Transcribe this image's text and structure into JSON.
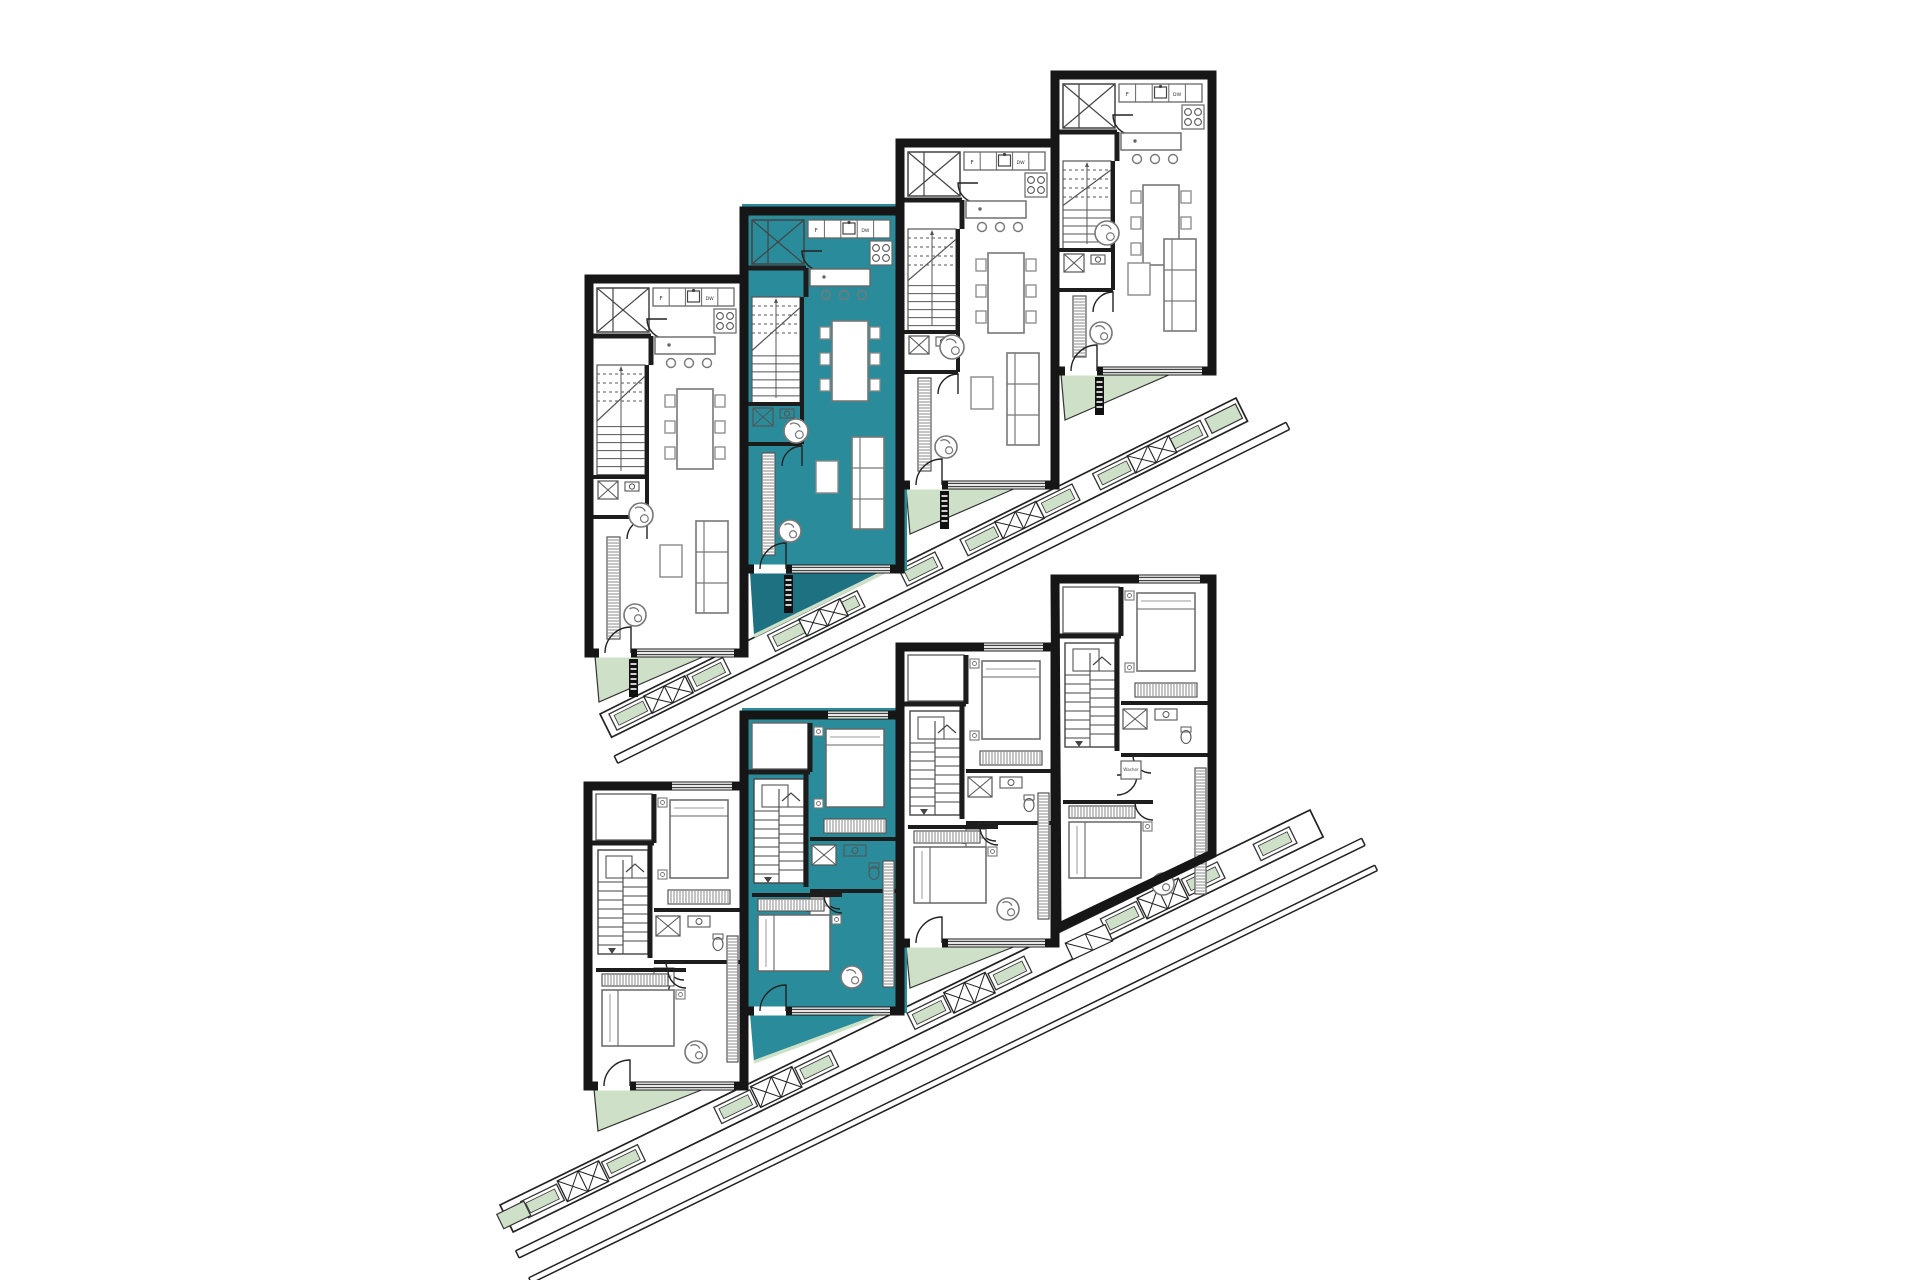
{
  "page": {
    "title": "Stacked townhouse floor plans with highlighted unit 2"
  },
  "canvas": {
    "w": 1920,
    "h": 1280,
    "bg": "#ffffff"
  },
  "colors": {
    "wall": "#161616",
    "partition": "#1c1c1c",
    "furniture": "#7d7d7d",
    "furniture_dark": "#4a4a4a",
    "line_dark": "#222222",
    "highlight": "#2A8C9A",
    "highlight_dark": "#1E7181",
    "planter_green": "#CFE0C8",
    "planter_stroke": "#333333",
    "white": "#ffffff"
  },
  "labels": {
    "fridge": "F",
    "dishwasher": "DW",
    "washer": "Washer"
  },
  "floors": [
    {
      "id": "upper-living-level",
      "unit_type": "living",
      "units": [
        {
          "id": "unit-1-living",
          "x": 589,
          "y": 279,
          "w": 155,
          "h": 374,
          "highlighted": false
        },
        {
          "id": "unit-2-living",
          "x": 744,
          "y": 211,
          "w": 156,
          "h": 358,
          "highlighted": true
        },
        {
          "id": "unit-3-living",
          "x": 900,
          "y": 143,
          "w": 155,
          "h": 342,
          "highlighted": false
        },
        {
          "id": "unit-4-living",
          "x": 1055,
          "y": 75,
          "w": 157,
          "h": 296,
          "highlighted": false
        }
      ],
      "wedge_depth": {
        "normal": 46,
        "highlight": 64
      },
      "promenade": {
        "p1": [
          600,
          714
        ],
        "p2": [
          1236,
          398
        ],
        "band_w": 26,
        "planters_t": [
          28,
          115,
          205,
          265,
          352,
          420,
          505,
          568,
          648
        ],
        "stairs_t": [
          70,
          243,
          462,
          610
        ],
        "rails": [
          [
            44,
            52
          ]
        ],
        "end_planter_t": 690
      },
      "ladders": true
    },
    {
      "id": "lower-bedroom-level",
      "unit_type": "bedroom",
      "units": [
        {
          "id": "unit-1-bedroom",
          "x": 588,
          "y": 786,
          "w": 156,
          "h": 300,
          "highlighted": false
        },
        {
          "id": "unit-2-bedroom",
          "x": 744,
          "y": 715,
          "w": 156,
          "h": 296,
          "highlighted": true
        },
        {
          "id": "unit-3-bedroom",
          "x": 900,
          "y": 647,
          "w": 155,
          "h": 296,
          "highlighted": false
        },
        {
          "id": "unit-4-bedroom",
          "x": 1055,
          "y": 579,
          "w": 157,
          "h": 296,
          "highlighted": false,
          "poly": [
            [
              1055,
              579
            ],
            [
              1212,
              579
            ],
            [
              1212,
              854
            ],
            [
              1057,
              928
            ]
          ]
        }
      ],
      "wedge_depth": {
        "normal": 42,
        "highlight": 48
      },
      "promenade": {
        "p1": [
          500,
          1205
        ],
        "p2": [
          1310,
          810
        ],
        "band_w": 30,
        "planters_t": [
          40,
          130,
          255,
          345,
          470,
          560,
          685,
          775,
          855
        ],
        "stairs_t": [
          85,
          300,
          515,
          730
        ],
        "rails": [
          [
            48,
            56
          ],
          [
            78,
            84
          ]
        ],
        "start_planter_t": 8
      },
      "ladders": false
    }
  ]
}
